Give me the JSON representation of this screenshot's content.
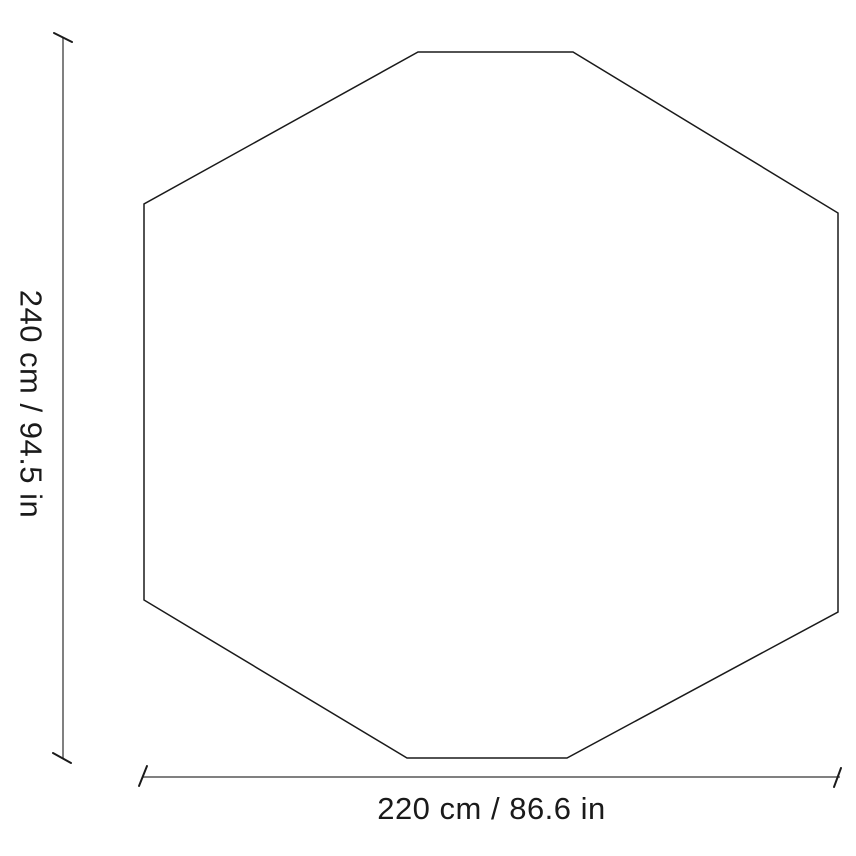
{
  "diagram": {
    "shape": "octagon",
    "height_dimension": {
      "label": "240 cm / 94.5 in",
      "cm": "240",
      "in": "94.5"
    },
    "width_dimension": {
      "label": "220 cm / 86.6 in",
      "cm": "220",
      "in": "86.6"
    },
    "colors": {
      "outline": "#1a1a1a",
      "dimension_line": "#808080",
      "tick": "#1a1a1a",
      "text": "#1a1a1a",
      "background": "#ffffff"
    }
  }
}
